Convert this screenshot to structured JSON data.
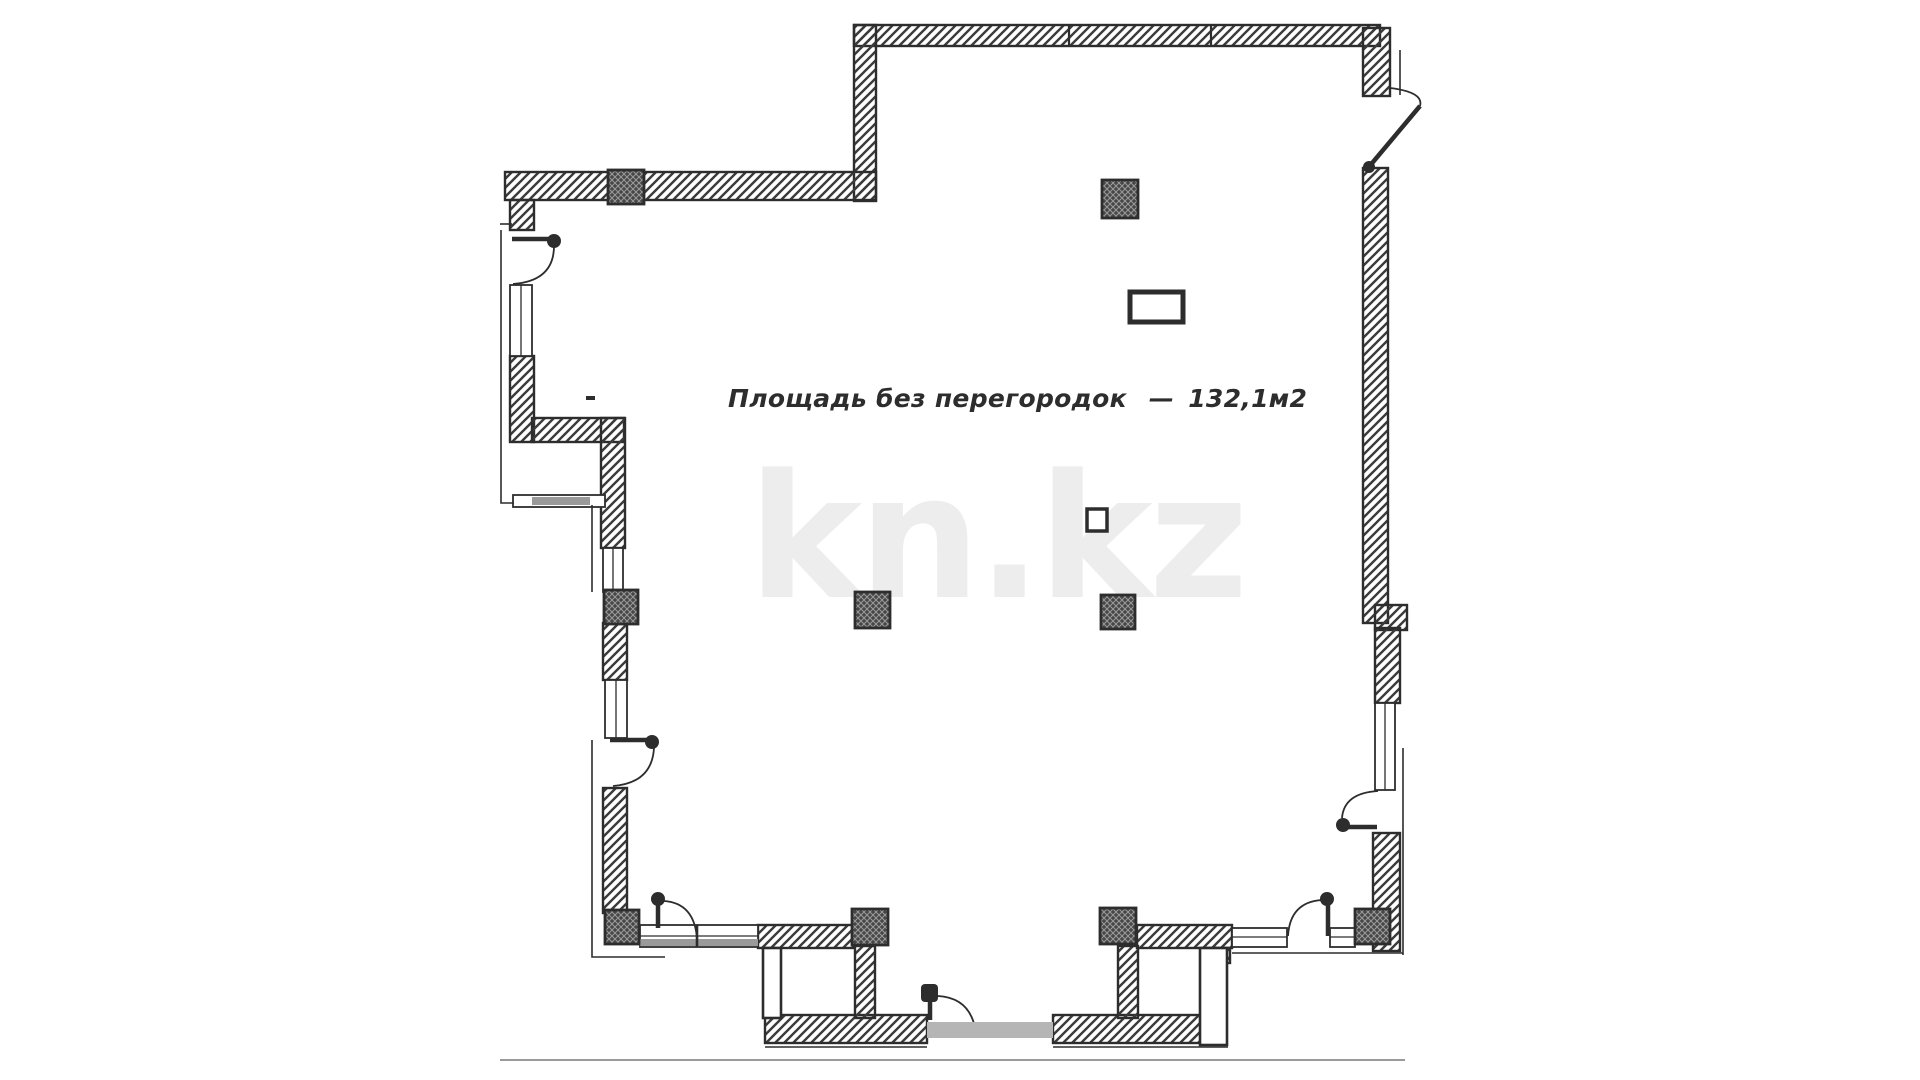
{
  "plan": {
    "watermark": "kn.kz",
    "annotation": {
      "area_label": "Площадь без перегородок",
      "separator": "—",
      "area_value": "132,1м2"
    },
    "colors": {
      "line": "#2d2d2d",
      "hatch": "#3b3b3b",
      "column_bg": "#474747",
      "column_lines": "#9b9b9b",
      "watermark": "#ededed",
      "threshold": "#b5b5b5",
      "sill": "#9a9a9a",
      "ground": "#9a9a9a"
    }
  }
}
